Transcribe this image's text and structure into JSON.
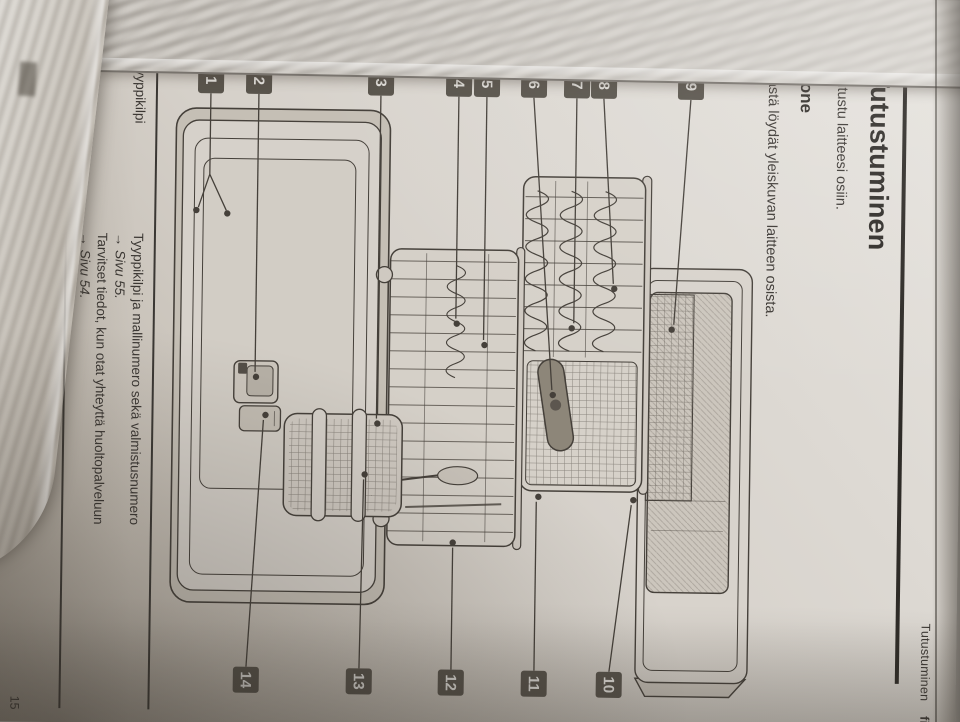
{
  "page": {
    "running_header": {
      "chapter": "Tutustuminen",
      "lang": "fi"
    },
    "title": "Tutustuminen",
    "intro": "Tutustu laitteesi osiin.",
    "section_heading": "Kone",
    "section_intro": "Tästä löydät yleiskuvan laitteen osista.",
    "figure": {
      "callouts": [
        "1",
        "2",
        "3",
        "4",
        "5",
        "6",
        "7",
        "8",
        "9",
        "10",
        "11",
        "12",
        "13",
        "14"
      ]
    },
    "info_table": {
      "rows": [
        {
          "term": "Tyyppikilpi",
          "lines": [
            {
              "text": "Tyyppikilpi ja mallinumero sekä valmistusnumero",
              "kind": "normal"
            },
            {
              "text": "→ Sivu 55.",
              "kind": "ref"
            },
            {
              "text": "Tarvitset tiedot, kun otat yhteyttä huoltopalveluun",
              "kind": "normal"
            },
            {
              "text": "→ Sivu 54.",
              "kind": "ref"
            }
          ]
        }
      ]
    },
    "footnote": "¹ Laitteen varustuksesta riippuen",
    "page_number": "15"
  },
  "colors": {
    "paper": "#d8d4ce",
    "ink": "#3b3733",
    "callout_square": "#59544c",
    "figure_line": "#45403a"
  }
}
